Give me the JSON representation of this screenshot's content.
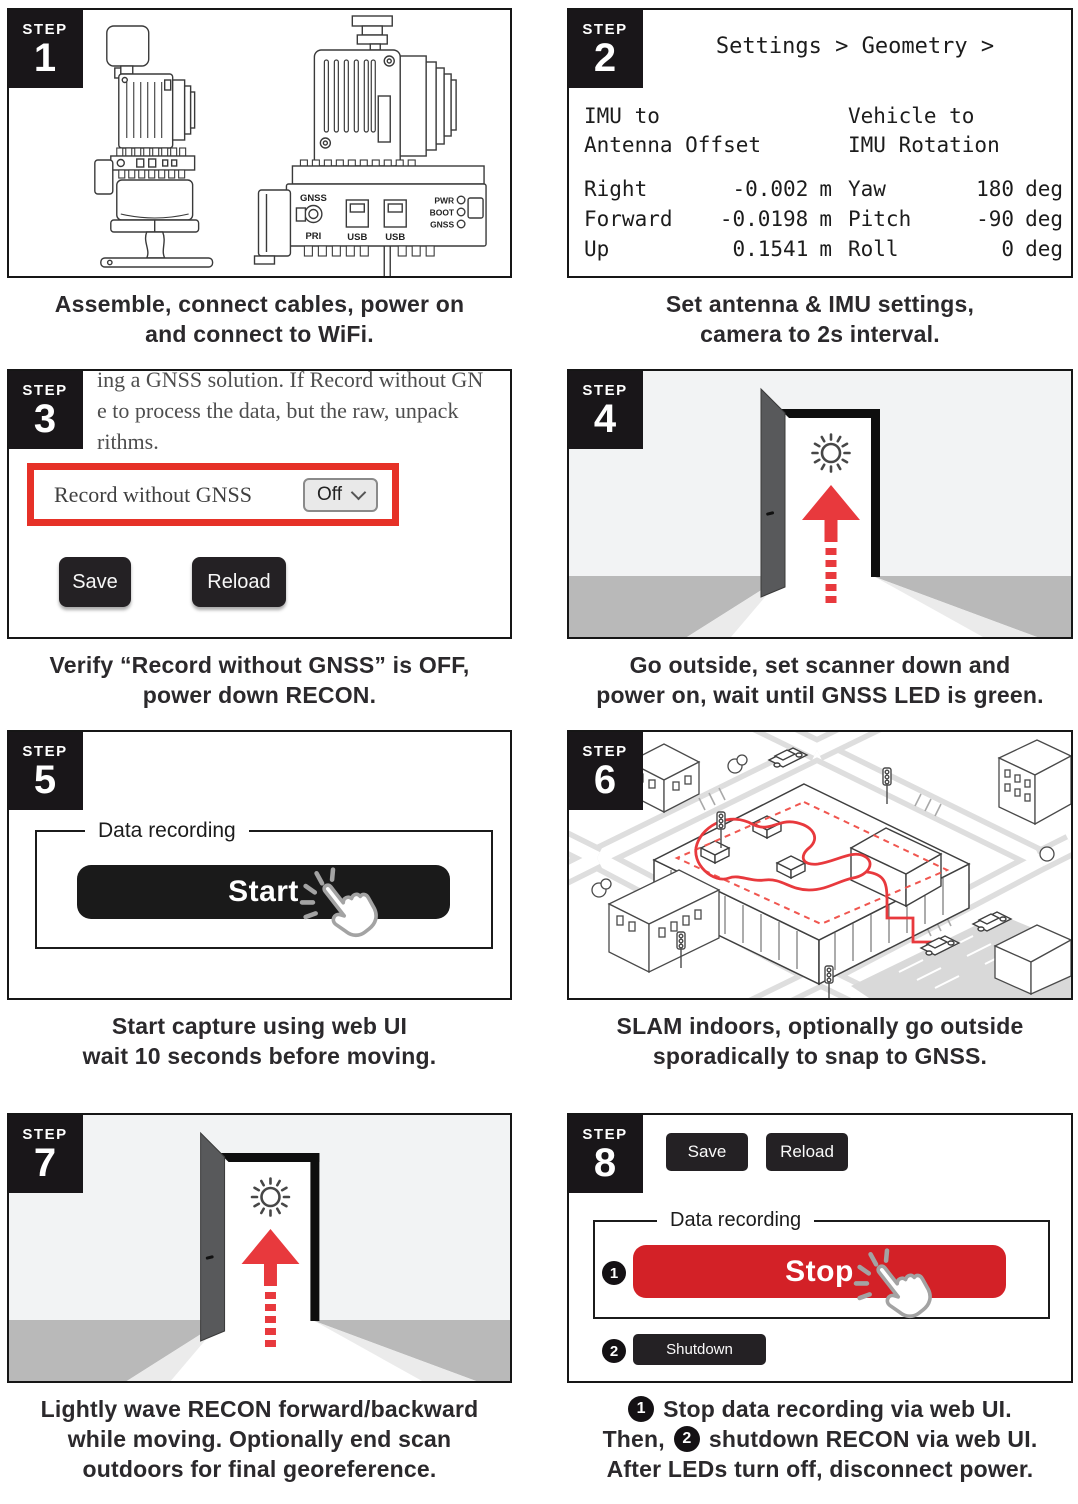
{
  "colors": {
    "accent_red_arrow": "#e8393d",
    "accent_red_button": "#d32127",
    "redbox_border": "#e63127",
    "badge_bg": "#191619",
    "dark_button": "#242124",
    "caption_text": "#2b292c",
    "door_sky": "#f2f3f4",
    "door_floor": "#b9b9b9",
    "door_panel": "#58595b"
  },
  "steps": [
    {
      "badge": "STEP",
      "num": "1",
      "caption_lines": [
        "Assemble, connect cables, power on",
        "and connect to WiFi."
      ]
    },
    {
      "badge": "STEP",
      "num": "2",
      "caption_lines": [
        "Set antenna & IMU settings,",
        "camera to 2s interval."
      ]
    },
    {
      "badge": "STEP",
      "num": "3",
      "caption_lines": [
        "Verify “Record without GNSS” is OFF,",
        "power down RECON."
      ]
    },
    {
      "badge": "STEP",
      "num": "4",
      "caption_lines": [
        "Go outside, set scanner down and",
        "power on, wait until GNSS LED is green."
      ]
    },
    {
      "badge": "STEP",
      "num": "5",
      "caption_lines": [
        "Start capture using web UI",
        "wait 10 seconds before moving."
      ]
    },
    {
      "badge": "STEP",
      "num": "6",
      "caption_lines": [
        "SLAM indoors, optionally go outside",
        "sporadically to snap to GNSS."
      ]
    },
    {
      "badge": "STEP",
      "num": "7",
      "caption_lines": [
        "Lightly wave RECON forward/backward",
        "while moving. Optionally end scan",
        "outdoors for final georeference."
      ]
    },
    {
      "badge": "STEP",
      "num": "8"
    }
  ],
  "step1": {
    "ports": {
      "gnss": "GNSS",
      "pri": "PRI",
      "usb_left": "USB",
      "usb_right": "USB",
      "led_pwr": "PWR",
      "led_boot": "BOOT",
      "led_gnss": "GNSS"
    }
  },
  "step2": {
    "breadcrumb": "Settings > Geometry >",
    "offset_title_1": "IMU to",
    "offset_title_2": "Antenna Offset",
    "rotation_title_1": "Vehicle to",
    "rotation_title_2": "IMU Rotation",
    "offset_rows": [
      {
        "label": "Right",
        "value": "-0.002",
        "unit": "m"
      },
      {
        "label": "Forward",
        "value": "-0.0198",
        "unit": "m"
      },
      {
        "label": "Up",
        "value": "0.1541",
        "unit": "m"
      }
    ],
    "rotation_rows": [
      {
        "label": "Yaw",
        "value": "180",
        "unit": "deg"
      },
      {
        "label": "Pitch",
        "value": "-90",
        "unit": "deg"
      },
      {
        "label": "Roll",
        "value": "0",
        "unit": "deg"
      }
    ]
  },
  "step3": {
    "clipped_lines": [
      "ing a GNSS solution. If Record without GN",
      "e to process the data, but the raw, unpack",
      "rithms."
    ],
    "field_label": "Record without GNSS",
    "select_value": "Off",
    "save_label": "Save",
    "reload_label": "Reload"
  },
  "step5": {
    "legend": "Data recording",
    "start_label": "Start"
  },
  "step8": {
    "save_label": "Save",
    "reload_label": "Reload",
    "legend": "Data recording",
    "stop_label": "Stop",
    "shutdown_label": "Shutdown",
    "marker1": "1",
    "marker2": "2",
    "caption": {
      "m1": "1",
      "line1": "Stop data recording via web UI.",
      "line2_pre": "Then,",
      "m2": "2",
      "line2_post": "shutdown RECON via web UI.",
      "line3": "After LEDs turn off, disconnect power."
    }
  }
}
